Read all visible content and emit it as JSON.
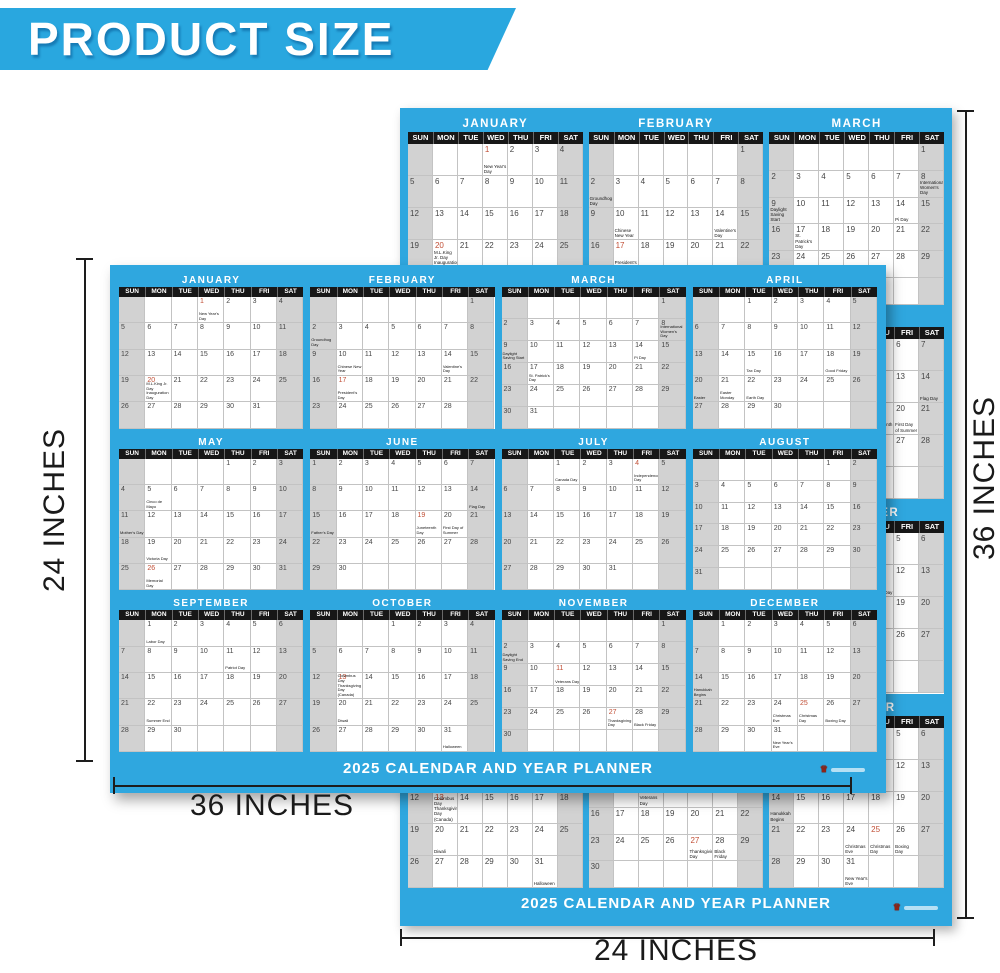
{
  "banner": {
    "title": "PRODUCT SIZE"
  },
  "colors": {
    "accent_blue": "#29a7df",
    "weekday_bar_black": "#171717",
    "weekend_gray": "#d2d2d2",
    "holiday_red": "#c14f36"
  },
  "weekday_labels": [
    "SUN",
    "MON",
    "TUE",
    "WED",
    "THU",
    "FRI",
    "SAT"
  ],
  "calendar_title": "2025 CALENDAR AND YEAR PLANNER",
  "footer_brand_icon": "crown-logo-icon",
  "months": [
    {
      "name": "JANUARY",
      "first_dow": 3,
      "days": 31,
      "holidays": [
        {
          "day": 1,
          "label": "New Year's Day",
          "red": true
        },
        {
          "day": 20,
          "label": "M.L.King Jr. Day Inauguration Day",
          "red": true
        }
      ]
    },
    {
      "name": "FEBRUARY",
      "first_dow": 6,
      "days": 28,
      "holidays": [
        {
          "day": 2,
          "label": "Groundhog Day"
        },
        {
          "day": 10,
          "label": "Chinese New Year"
        },
        {
          "day": 14,
          "label": "Valentine's Day"
        },
        {
          "day": 17,
          "label": "President's Day",
          "red": true
        }
      ]
    },
    {
      "name": "MARCH",
      "first_dow": 6,
      "days": 31,
      "holidays": [
        {
          "day": 8,
          "label": "International Women's Day"
        },
        {
          "day": 9,
          "label": "Daylight Saving Start"
        },
        {
          "day": 14,
          "label": "Pi Day"
        },
        {
          "day": 17,
          "label": "St. Patrick's Day"
        }
      ]
    },
    {
      "name": "APRIL",
      "first_dow": 2,
      "days": 30,
      "holidays": [
        {
          "day": 15,
          "label": "Tax Day"
        },
        {
          "day": 18,
          "label": "Good Friday"
        },
        {
          "day": 20,
          "label": "Easter"
        },
        {
          "day": 21,
          "label": "Easter Monday"
        },
        {
          "day": 22,
          "label": "Earth Day"
        }
      ]
    },
    {
      "name": "MAY",
      "first_dow": 4,
      "days": 31,
      "holidays": [
        {
          "day": 5,
          "label": "Cinco de Mayo"
        },
        {
          "day": 11,
          "label": "Mother's Day"
        },
        {
          "day": 19,
          "label": "Victoria Day"
        },
        {
          "day": 26,
          "label": "Memorial Day",
          "red": true
        }
      ]
    },
    {
      "name": "JUNE",
      "first_dow": 0,
      "days": 30,
      "holidays": [
        {
          "day": 14,
          "label": "Flag Day"
        },
        {
          "day": 15,
          "label": "Father's Day"
        },
        {
          "day": 19,
          "label": "Juneteenth Day",
          "red": true
        },
        {
          "day": 20,
          "label": "First Day of Summer"
        }
      ]
    },
    {
      "name": "JULY",
      "first_dow": 2,
      "days": 31,
      "holidays": [
        {
          "day": 1,
          "label": "Canada Day"
        },
        {
          "day": 4,
          "label": "Independence Day",
          "red": true
        }
      ]
    },
    {
      "name": "AUGUST",
      "first_dow": 5,
      "days": 31,
      "holidays": []
    },
    {
      "name": "SEPTEMBER",
      "first_dow": 1,
      "days": 30,
      "holidays": [
        {
          "day": 1,
          "label": "Labor Day"
        },
        {
          "day": 11,
          "label": "Patriot Day"
        },
        {
          "day": 22,
          "label": "Summer End"
        }
      ]
    },
    {
      "name": "OCTOBER",
      "first_dow": 3,
      "days": 31,
      "holidays": [
        {
          "day": 13,
          "label": "Columbus Day Thanksgiving Day (Canada)",
          "red": true
        },
        {
          "day": 20,
          "label": "Diwali"
        },
        {
          "day": 31,
          "label": "Halloween"
        }
      ]
    },
    {
      "name": "NOVEMBER",
      "first_dow": 6,
      "days": 30,
      "holidays": [
        {
          "day": 2,
          "label": "Daylight Saving End"
        },
        {
          "day": 11,
          "label": "Veterans Day",
          "red": true
        },
        {
          "day": 27,
          "label": "Thanksgiving Day",
          "red": true
        },
        {
          "day": 28,
          "label": "Black Friday"
        }
      ]
    },
    {
      "name": "DECEMBER",
      "first_dow": 1,
      "days": 31,
      "holidays": [
        {
          "day": 14,
          "label": "Hanukkah Begins"
        },
        {
          "day": 24,
          "label": "Christmas Eve"
        },
        {
          "day": 25,
          "label": "Christmas Day",
          "red": true
        },
        {
          "day": 26,
          "label": "Boxing Day"
        },
        {
          "day": 31,
          "label": "New Year's Eve"
        }
      ]
    }
  ],
  "dimensions": {
    "front_height": "24 INCHES",
    "front_width": "36 INCHES",
    "back_height": "36 INCHES",
    "back_width": "24 INCHES"
  }
}
